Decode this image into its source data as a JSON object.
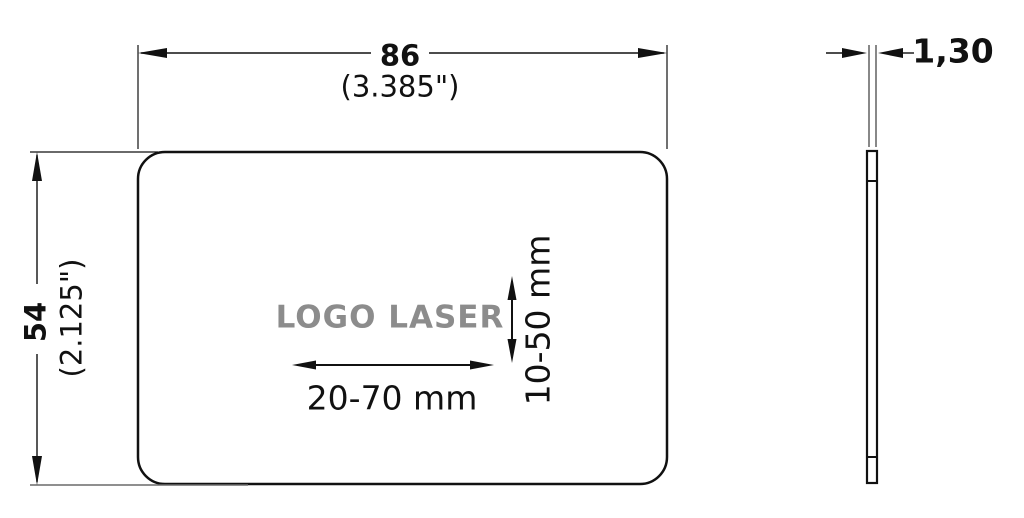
{
  "front_view": {
    "width_dim": {
      "value": "86",
      "inches": "(3.385\")"
    },
    "height_dim": {
      "value": "54",
      "inches": "(2.125\")"
    },
    "logo_area": {
      "label": "LOGO LASER",
      "width_range": "20-70 mm",
      "height_range": "10-50 mm"
    }
  },
  "side_view": {
    "thickness_dim": {
      "value": "1,30"
    }
  },
  "colors": {
    "line": "#111111",
    "logo_gray": "#8c8c8c",
    "background": "#ffffff"
  }
}
